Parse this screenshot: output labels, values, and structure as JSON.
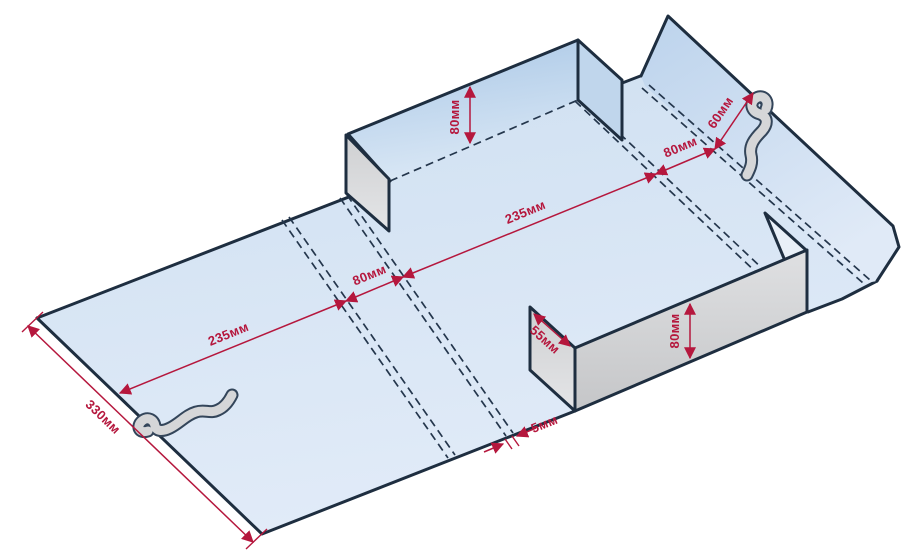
{
  "diagram": {
    "kind": "isometric-box-dieline",
    "unit": "мм",
    "colors": {
      "background": "#ffffff",
      "panel_blue": "#d9e7f5",
      "wall_blue_dark": "#aecae7",
      "side_flap_blue": "#c0d6ec",
      "flap_gray": "#d6d7d9",
      "outline": "#1e2e40",
      "dimension_red": "#b5173d"
    },
    "dimensions": {
      "left_panel_length": "235мм",
      "left_fold_strip": "80мм",
      "center_panel_length": "235мм",
      "right_fold_strip": "80мм",
      "right_flap_depth": "60мм",
      "sheet_width": "330мм",
      "back_wall_height": "80мм",
      "front_wall_height": "80мм",
      "front_side_flap_width": "55мм",
      "crease_gap": "5мм"
    }
  }
}
